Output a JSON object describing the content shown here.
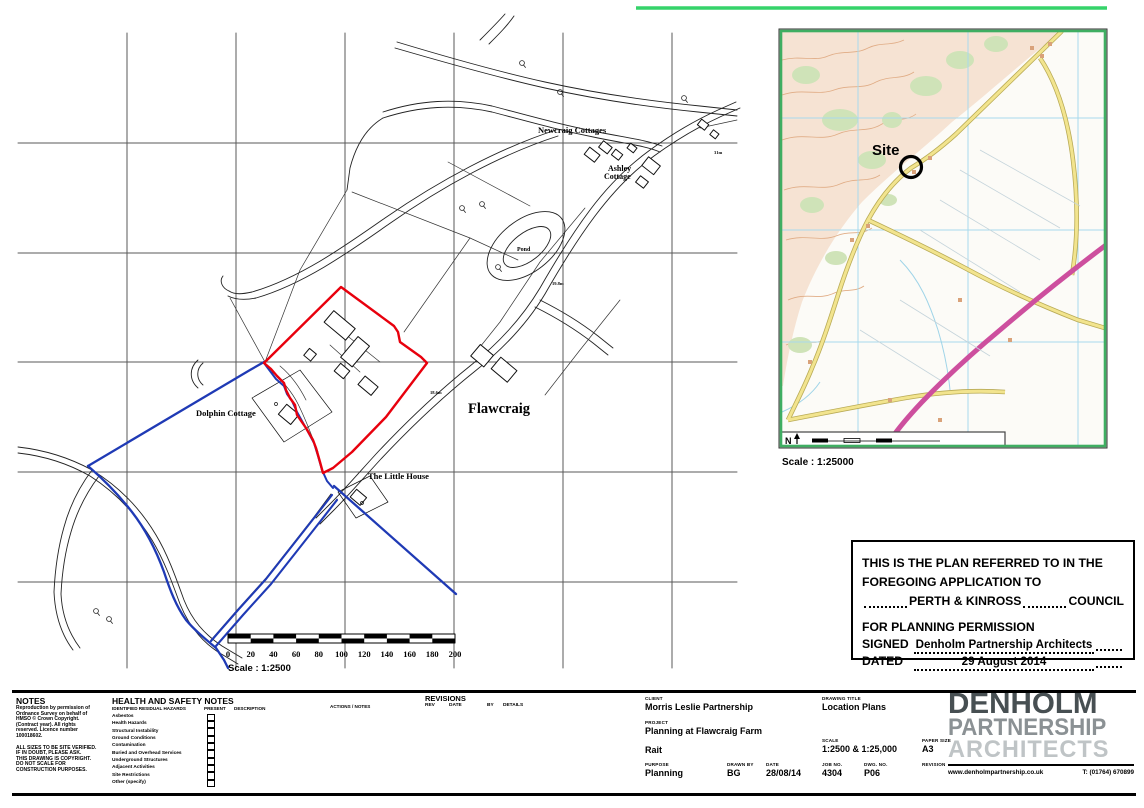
{
  "sheet": {
    "highlight_color": "#35d36a",
    "site_boundary_color": "#e8000d",
    "ownership_boundary_color": "#1f3ab5"
  },
  "main_plan": {
    "labels": {
      "newcraig": "Newcraig Cottages",
      "ashley_1": "Ashley",
      "ashley_2": "Cottage",
      "pond": "Pond",
      "flawcraig": "Flawcraig",
      "dolphin": "Dolphin Cottage",
      "little_house": "The Little House",
      "spot_height_1": "31m",
      "spot_height_2": "19.8m",
      "spot_height_3": "18.6m"
    },
    "scale_bar": {
      "ticks": [
        "0",
        "20",
        "40",
        "60",
        "80",
        "100",
        "120",
        "140",
        "160",
        "180",
        "200"
      ],
      "scale_text": "Scale  :  1:2500"
    }
  },
  "inset_map": {
    "site_label": "Site",
    "north_label": "N",
    "scale_text": "Scale  :  1:25000"
  },
  "statement_box": {
    "line1": "THIS IS THE PLAN REFERRED TO IN THE",
    "line2": "FOREGOING APPLICATION TO",
    "council": "PERTH & KINROSS",
    "council_suffix": "COUNCIL",
    "line3": "FOR PLANNING PERMISSION",
    "signed_label": "SIGNED",
    "signed_value": "Denholm Partnership Architects",
    "dated_label": "DATED",
    "dated_value": "29 August 2014"
  },
  "title_block": {
    "notes": {
      "title": "NOTES",
      "block1": [
        "Reproduction by permission of",
        "Ordnance Survey on behalf of",
        "HMSO © Crown Copyright.",
        "(Contract year). All rights",
        "reserved. Licence number",
        "100018602."
      ],
      "block2": [
        "ALL SIZES TO BE SITE VERIFIED.",
        "IF IN DOUBT, PLEASE ASK.",
        "THIS DRAWING IS COPYRIGHT.",
        "DO NOT SCALE FOR",
        "CONSTRUCTION PURPOSES."
      ]
    },
    "hs": {
      "title": "HEALTH AND SAFETY NOTES",
      "col_hazards": "IDENTIFIED RESIDUAL HAZARDS",
      "col_present": "PRESENT",
      "col_description": "DESCRIPTION",
      "col_actions": "ACTIONS / NOTES",
      "items": [
        "Asbestos",
        "Health Hazards",
        "Structural Instability",
        "Ground Conditions",
        "Contamination",
        "Buried and Overhead Services",
        "Underground Structures",
        "Adjacent Activities",
        "Site Restrictions",
        "Other (specify)"
      ]
    },
    "revisions": {
      "title": "REVISIONS",
      "col_rev": "REV",
      "col_date": "DATE",
      "col_by": "BY",
      "col_details": "DETAILS"
    },
    "client_label": "CLIENT",
    "client": "Morris Leslie Partnership",
    "project_label": "PROJECT",
    "project": "Planning at Flawcraig Farm",
    "location": "Rait",
    "purpose_label": "PURPOSE",
    "purpose": "Planning",
    "drawn_by_label": "DRAWN BY",
    "drawn_by": "BG",
    "date_label": "DATE",
    "date": "28/08/14",
    "drawing_title_label": "DRAWING TITLE",
    "drawing_title": "Location Plans",
    "scale_label": "SCALE",
    "scale": "1:2500 & 1:25,000",
    "paper_label": "PAPER SIZE",
    "paper": "A3",
    "job_label": "JOB NO.",
    "job": "4304",
    "dwg_label": "DWG. NO.",
    "dwg": "P06",
    "revision_label": "REVISION",
    "logo": {
      "line1": "DENHOLM",
      "line2": "PARTNERSHIP",
      "line3": "ARCHITECTS",
      "website": "www.denholmpartnership.co.uk",
      "phone": "T: (01764) 670899"
    }
  }
}
